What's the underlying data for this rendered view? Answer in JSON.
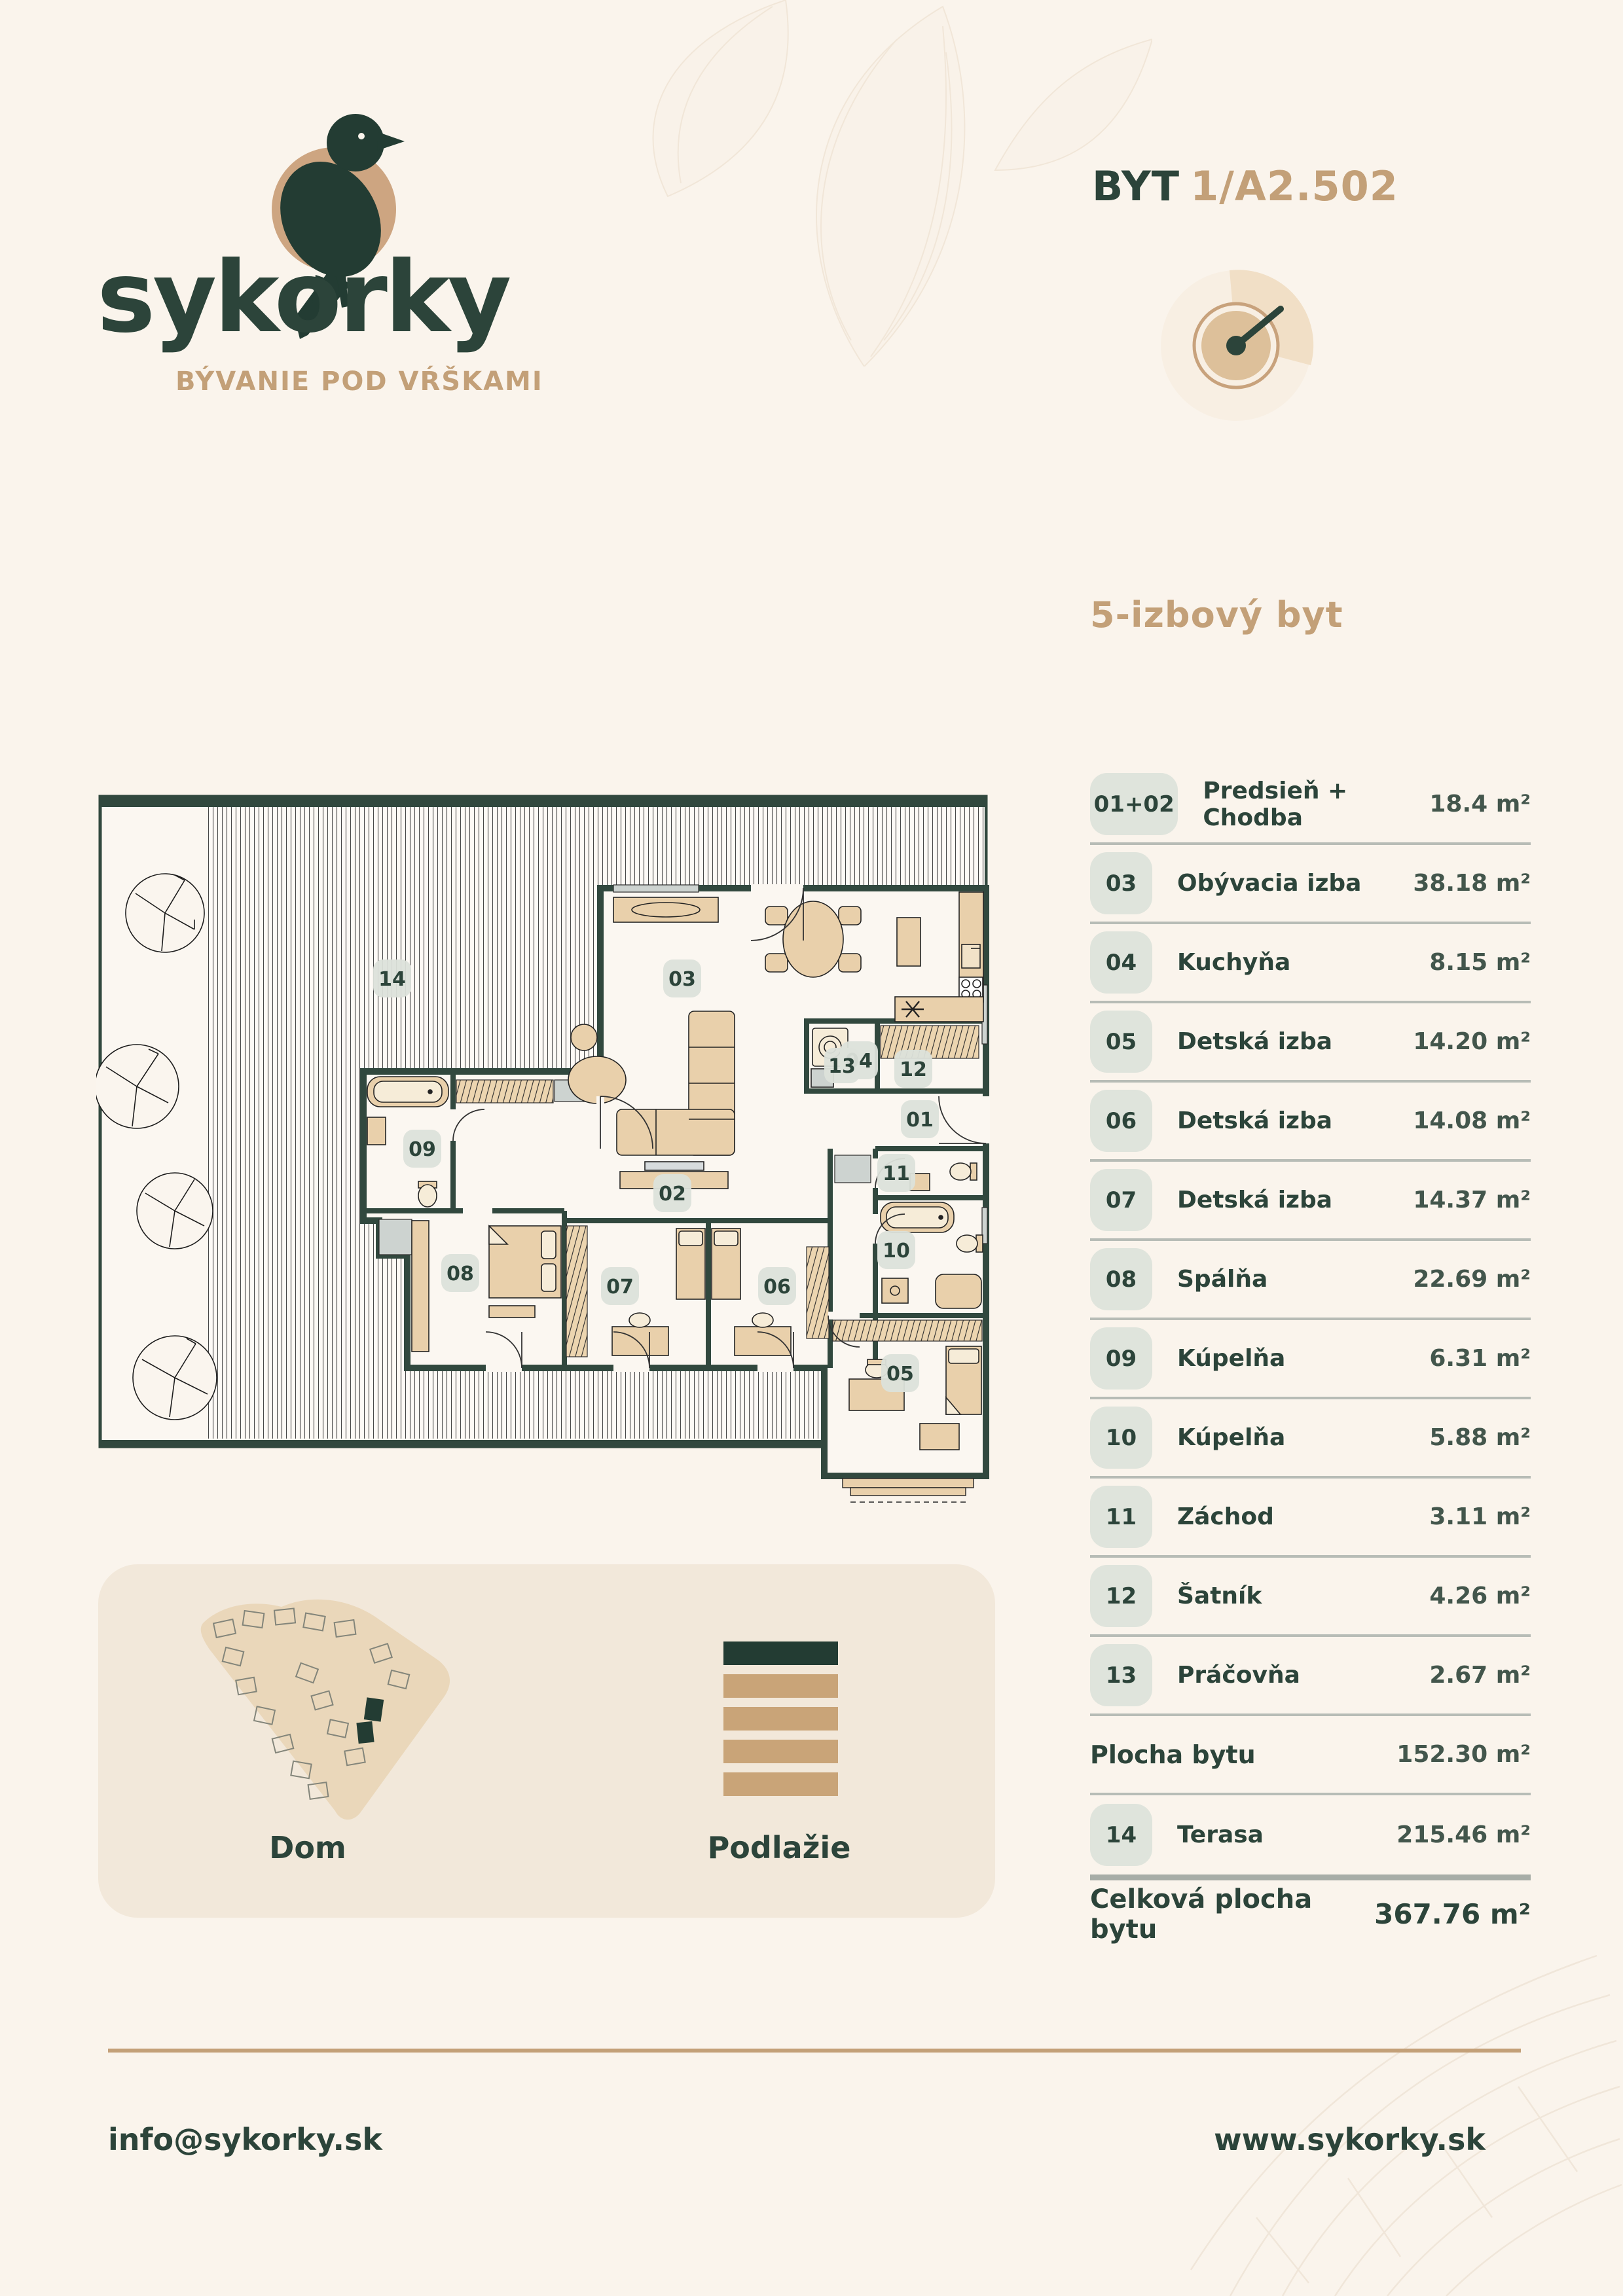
{
  "logo": {
    "brand": "sykorky",
    "tagline": "BÝVANIE POD VŔŠKAMI"
  },
  "header": {
    "unit_label": "BYT",
    "unit_number": "1/A2.502"
  },
  "apartment": {
    "type_heading": "5-izbový byt"
  },
  "rooms": [
    {
      "number": "01+02",
      "name": "Predsieň + Chodba",
      "area": "18.4 m²"
    },
    {
      "number": "03",
      "name": "Obývacia izba",
      "area": "38.18 m²"
    },
    {
      "number": "04",
      "name": "Kuchyňa",
      "area": "8.15 m²"
    },
    {
      "number": "05",
      "name": "Detská izba",
      "area": "14.20 m²"
    },
    {
      "number": "06",
      "name": "Detská izba",
      "area": "14.08 m²"
    },
    {
      "number": "07",
      "name": "Detská izba",
      "area": "14.37 m²"
    },
    {
      "number": "08",
      "name": "Spálňa",
      "area": "22.69 m²"
    },
    {
      "number": "09",
      "name": "Kúpelňa",
      "area": "6.31 m²"
    },
    {
      "number": "10",
      "name": "Kúpelňa",
      "area": "5.88 m²"
    },
    {
      "number": "11",
      "name": "Záchod",
      "area": "3.11 m²"
    },
    {
      "number": "12",
      "name": "Šatník",
      "area": "4.26 m²"
    },
    {
      "number": "13",
      "name": "Práčovňa",
      "area": "2.67 m²"
    }
  ],
  "summary": {
    "plocha_label": "Plocha bytu",
    "plocha_value": "152.30 m²",
    "terasa_number": "14",
    "terasa_name": "Terasa",
    "terasa_area": "215.46 m²",
    "total_label": "Celková plocha bytu",
    "total_value": "367.76 m²"
  },
  "floorplan": {
    "labels": [
      "01",
      "02",
      "03",
      "04",
      "05",
      "06",
      "07",
      "08",
      "09",
      "10",
      "11",
      "12",
      "13",
      "14"
    ]
  },
  "locator": {
    "dom_label": "Dom",
    "podlazie_label": "Podlažie",
    "floors_total": 5,
    "selected_floor_from_top": 1
  },
  "footer": {
    "email": "info@sykorky.sk",
    "website": "www.sykorky.sk"
  },
  "colors": {
    "background": "#faf4ec",
    "dark_green": "#2c443a",
    "tan_accent": "#c3a078",
    "badge_bg": "#dfe4dc",
    "panel_bg": "#f2e8da"
  }
}
